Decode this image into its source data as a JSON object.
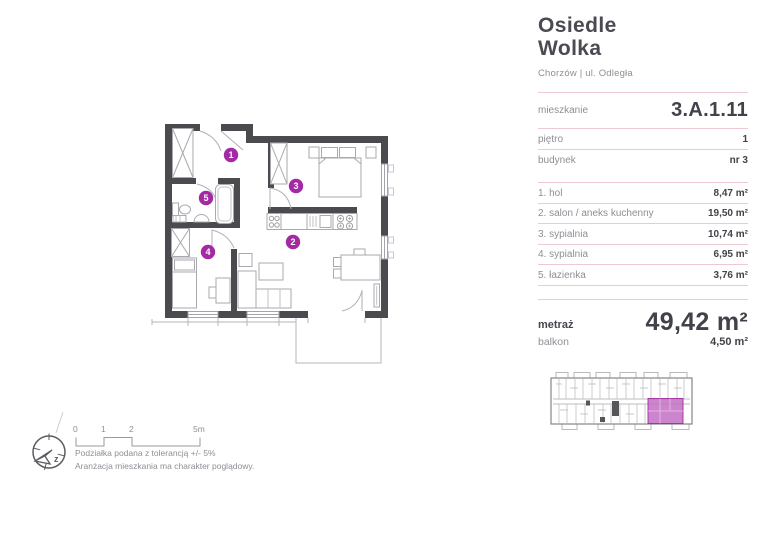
{
  "header": {
    "title_line1": "Osiedle",
    "title_line2": "Wolka",
    "subtitle": "Chorzów | ul. Odległa"
  },
  "details": {
    "rows": [
      {
        "label": "mieszkanie",
        "value": "3.A.1.11"
      },
      {
        "label": "piętro",
        "value": "1"
      },
      {
        "label": "budynek",
        "value": "nr 3"
      }
    ]
  },
  "rooms": [
    {
      "label": "1. hol",
      "area": "8,47 m²"
    },
    {
      "label": "2. salon / aneks kuchenny",
      "area": "19,50 m²"
    },
    {
      "label": "3. sypialnia",
      "area": "10,74 m²"
    },
    {
      "label": "4. sypialnia",
      "area": "6,95 m²"
    },
    {
      "label": "5. łazienka",
      "area": "3,76 m²"
    }
  ],
  "summary": {
    "metraz_label": "metraż",
    "metraz_value": "49,42 m²",
    "balkon_label": "balkon",
    "balkon_value": "4,50 m²"
  },
  "plan": {
    "numbers": [
      "1",
      "2",
      "3",
      "4",
      "5"
    ]
  },
  "scalebar": {
    "t0": "0",
    "t1": "1",
    "t2": "2",
    "t5": "5m"
  },
  "compass": {
    "label": "z"
  },
  "notes": [
    "Podziałka podana z tolerancją +/- 5%",
    "Aranżacja mieszkania ma charakter poglądowy."
  ],
  "colors": {
    "accent": "#a32aa3",
    "minimap_highlight": "#c36fc3",
    "wall": "#4b4b4f",
    "divider_pink": "#ecc9d3"
  }
}
